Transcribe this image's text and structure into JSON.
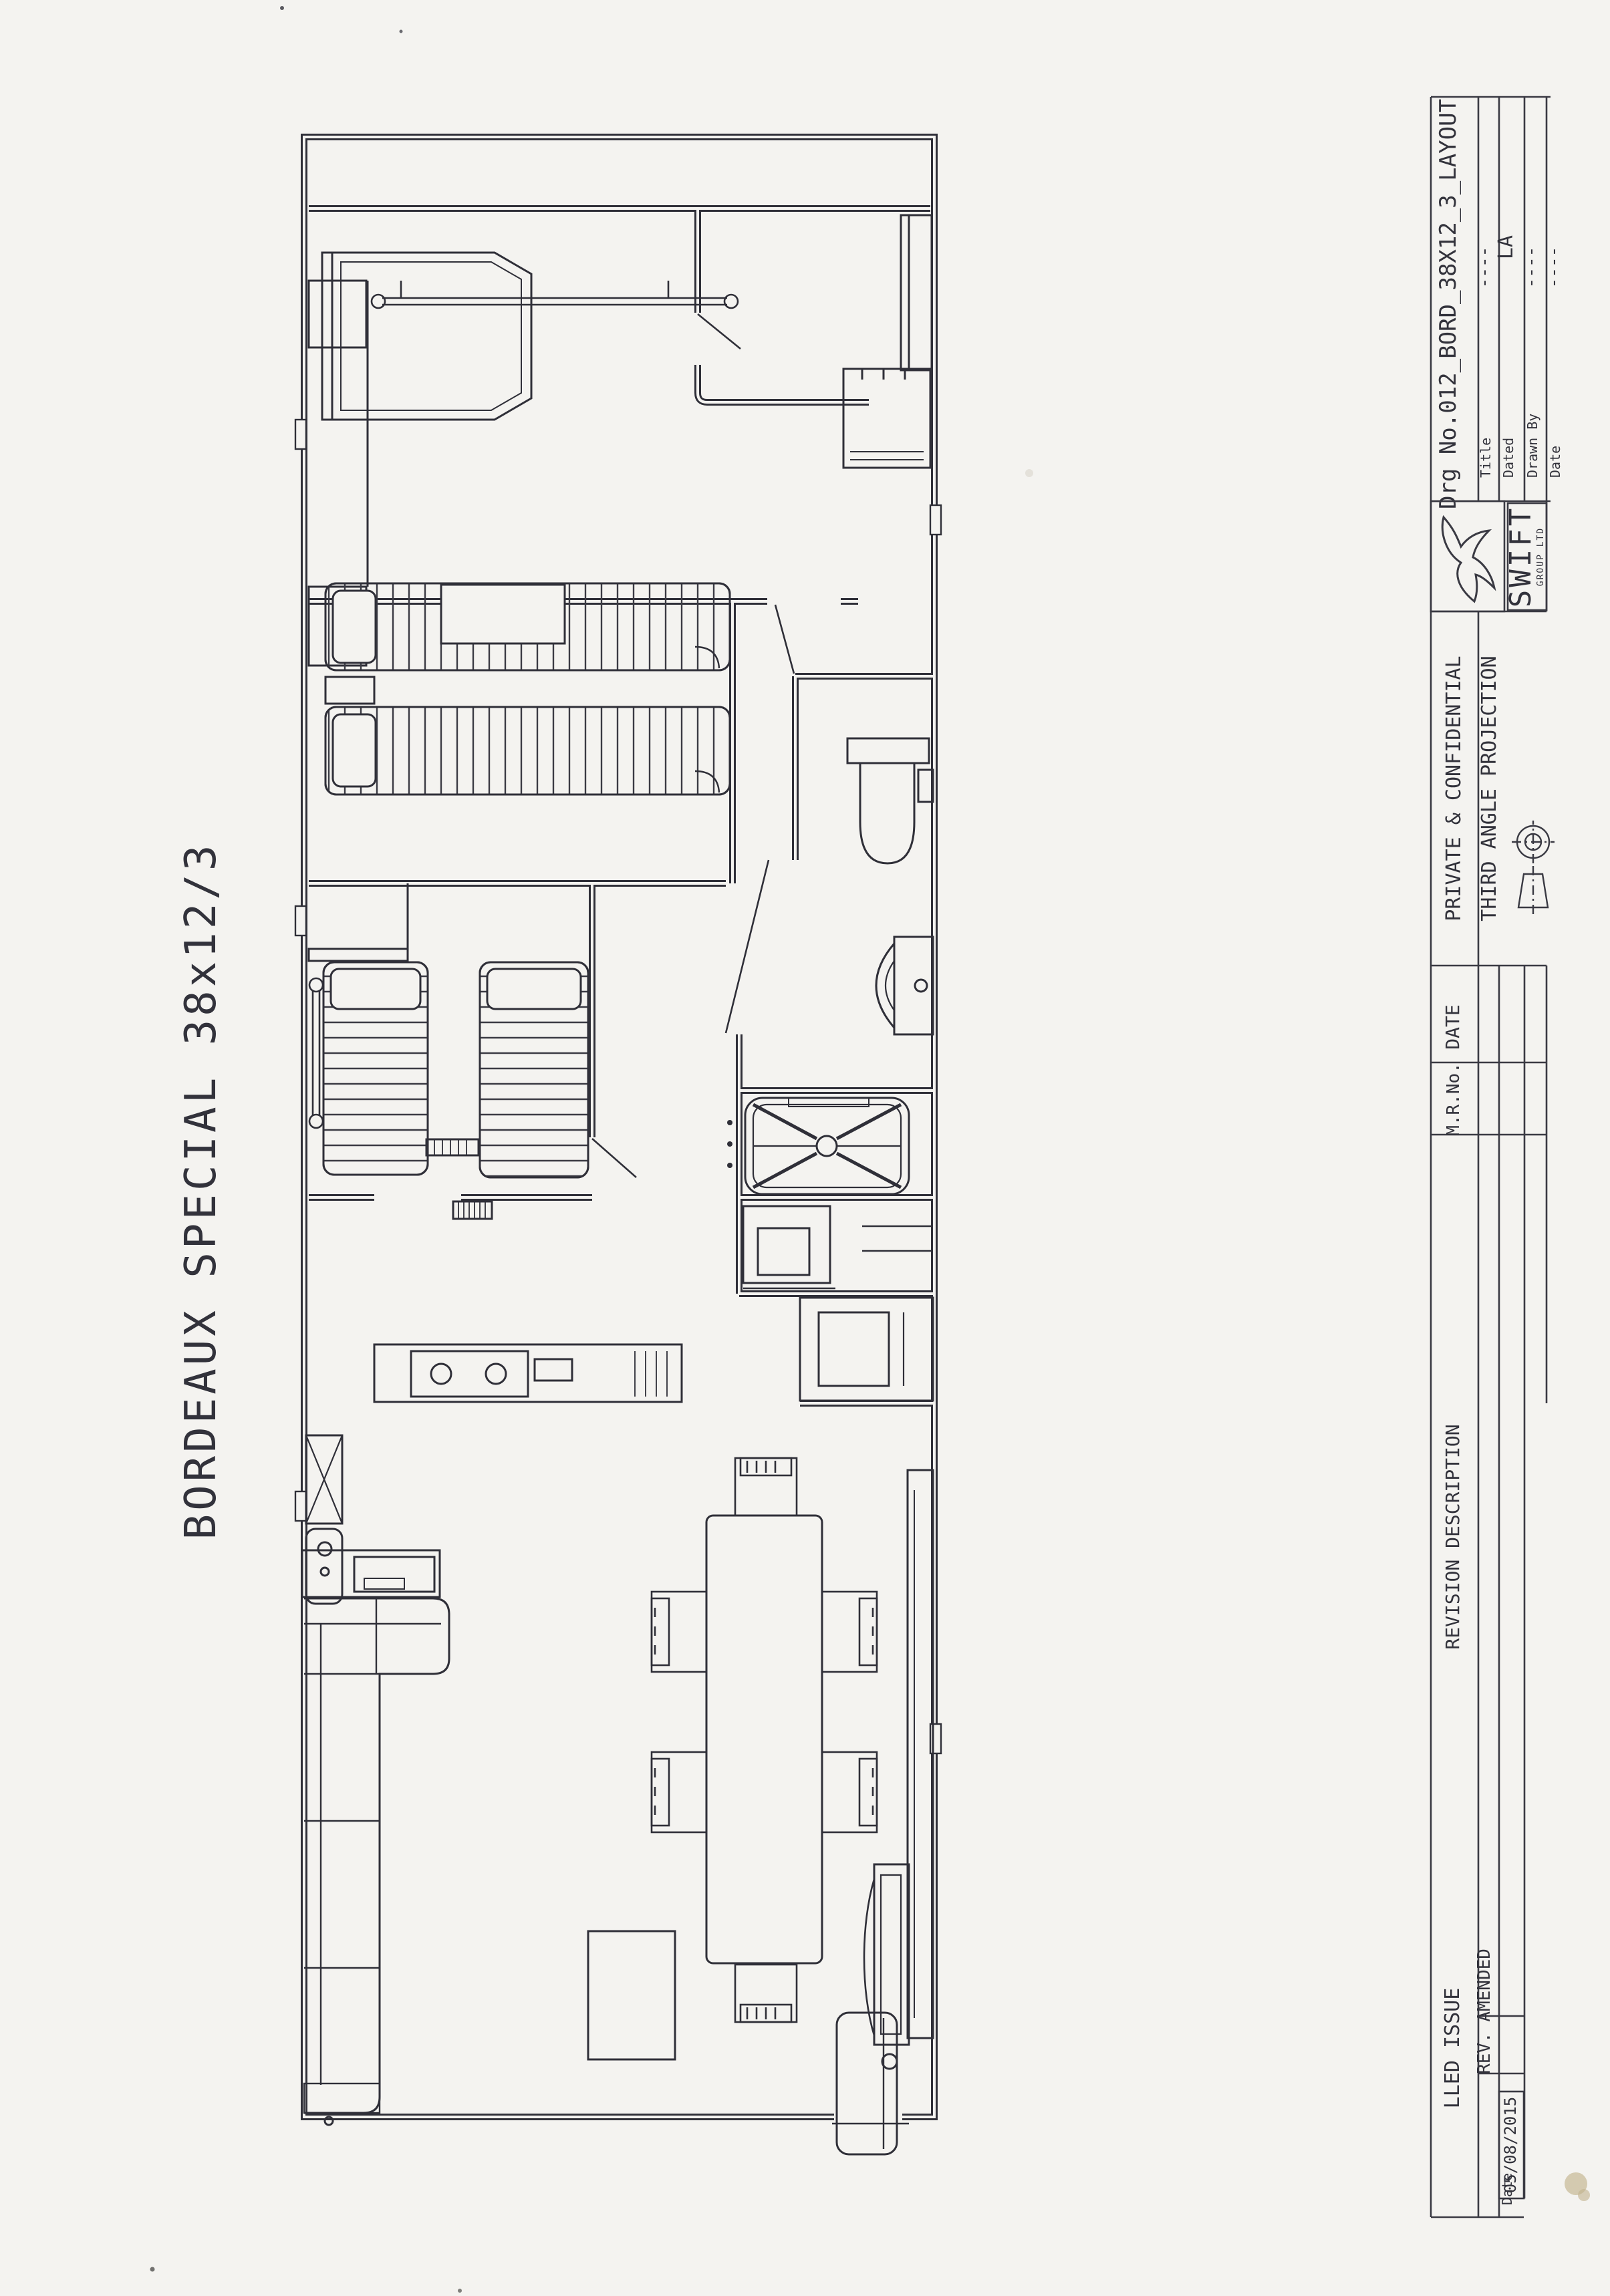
{
  "page": {
    "background": "#f4f3f0",
    "ink": "#32323b"
  },
  "drawing_title": "BORDEAUX SPECIAL 38x12/3",
  "title_block": {
    "drg_no": "Drg No.012_BORD_38X12_3_LAYOUT",
    "fields": [
      {
        "label": "Title",
        "value": "----"
      },
      {
        "label": "Dated",
        "value": "LA"
      },
      {
        "label": "Drawn By",
        "value": "----"
      },
      {
        "label": "Date",
        "value": "----"
      }
    ],
    "company": "SWIFT",
    "company_sub": "GROUP LTD",
    "logo": "swift-bird-logo",
    "confidentiality": "PRIVATE & CONFIDENTIAL",
    "projection": "THIRD ANGLE PROJECTION",
    "revision_table": {
      "columns": [
        "DATE",
        "M.R.No.",
        "REVISION DESCRIPTION"
      ],
      "issue_text": "LLED ISSUE",
      "rev_text": "REV. AMENDED",
      "date_label": "Date",
      "date_value": "05/08/2015"
    }
  },
  "floor_plan": {
    "model": "BORDEAUX SPECIAL 38x12/3",
    "features": [
      "double-bed",
      "headboard-rail",
      "wardrobe",
      "overhead-locker",
      "twin-single-beds",
      "child-single-beds",
      "toilet",
      "wash-basin",
      "shower-enclosure",
      "vanity-unit",
      "airing-cupboard",
      "kitchen-sink",
      "drainer",
      "hob",
      "worktop",
      "oven-housing",
      "corner-sofa",
      "coffee-table",
      "dining-table",
      "dining-chairs",
      "sideboard",
      "media-unit",
      "entrance-door"
    ]
  }
}
